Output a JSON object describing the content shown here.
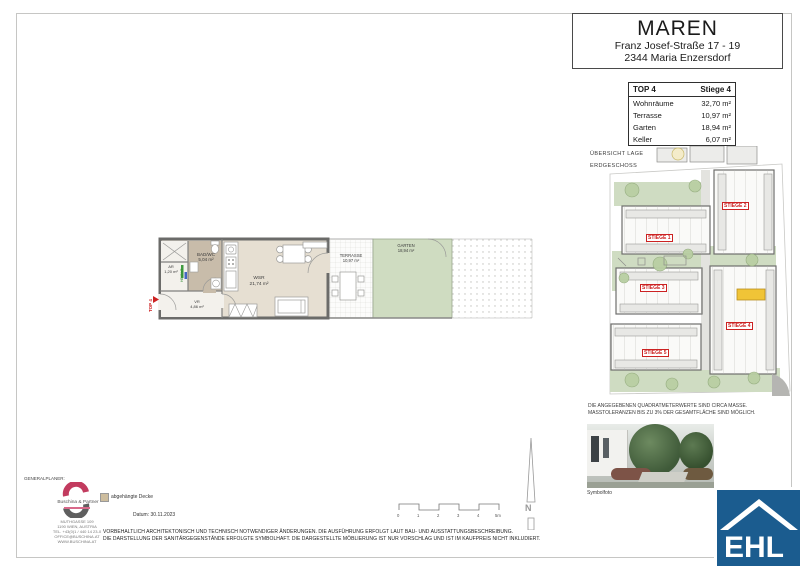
{
  "header": {
    "title": "MAREN",
    "address1": "Franz Josef-Straße 17 - 19",
    "address2": "2344  Maria Enzersdorf"
  },
  "unit_table": {
    "col_unit": "TOP 4",
    "col_stiege": "Stiege 4",
    "rows": [
      {
        "label": "Wohnräume",
        "value": "32,70 m²"
      },
      {
        "label": "Terrasse",
        "value": "10,97 m²"
      },
      {
        "label": "Garten",
        "value": "18,94 m²"
      },
      {
        "label": "Keller",
        "value": "6,07 m²"
      }
    ]
  },
  "overview": {
    "line1": "ÜBERSICHT LAGE",
    "line2": "ERDGESCHOSS"
  },
  "site_plan": {
    "labels": [
      "STIEGE 1",
      "STIEGE 2",
      "STIEGE 3",
      "STIEGE 4",
      "STIEGE 5"
    ],
    "highlight_color": "#f0c437"
  },
  "notes": {
    "line1": "DIE ANGEGEBENEN QUADRATMETERWERTE SIND CIRCA MASSE.",
    "line2": "MASSTOLERANZEN BIS ZU 3% DER GESAMTFLÄCHE SIND MÖGLICH."
  },
  "photo": {
    "caption": "Symbolfoto"
  },
  "brand": {
    "ehl": "EHL",
    "blue": "#1b5c8f"
  },
  "floor_plan": {
    "top_label": "TOP 4",
    "heiz": "HEIZ/VT",
    "rooms": {
      "badwc": {
        "name": "BAD/WC",
        "area": "5,04 m²"
      },
      "ar": {
        "name": "AR",
        "area": "1,20 m²"
      },
      "vr": {
        "name": "VR",
        "area": "4,86 m²"
      },
      "wsr": {
        "name": "WSR",
        "area": "21,74 m²"
      },
      "terrasse": {
        "name": "TERRASSE",
        "area": "10,97 m²"
      },
      "garten": {
        "name": "GARTEN",
        "area": "18,94 m²"
      }
    }
  },
  "planner": {
    "role": "GENERALPLANER:",
    "company": "Buschina & Partner",
    "address": [
      "MUTHGASSE 109",
      "1190 WIEN, AUSTRIA",
      "TEL. +43(0)1 / 440 14 23-0",
      "OFFICE@BUSCHINA.AT",
      "WWW.BUSCHINA.AT"
    ]
  },
  "legend": {
    "label": "abgehängte Decke",
    "swatch_color": "#cdbd9e"
  },
  "meta": {
    "date": "Datum: 30.11.2023"
  },
  "disclaimer": {
    "line1": "VORBEHALTLICH ARCHITEKTONISCH UND TECHNISCH NOTWENDIGER ÄNDERUNGEN. DIE AUSFÜHRUNG ERFOLGT LAUT BAU- UND AUSSTATTUNGSBESCHREIBUNG.",
    "line2": "DIE DARSTELLUNG DER SANITÄRGEGENSTÄNDE ERFOLGTE SYMBOLHAFT. DIE DARGESTELLTE MÖBLIERUNG IST NUR VORSCHLAG UND IST IM KAUFPREIS NICHT INKLUDIERT."
  },
  "scale": {
    "ticks": [
      "0",
      "1",
      "2",
      "3",
      "4",
      "5m"
    ]
  },
  "north": {
    "letter": "N"
  }
}
